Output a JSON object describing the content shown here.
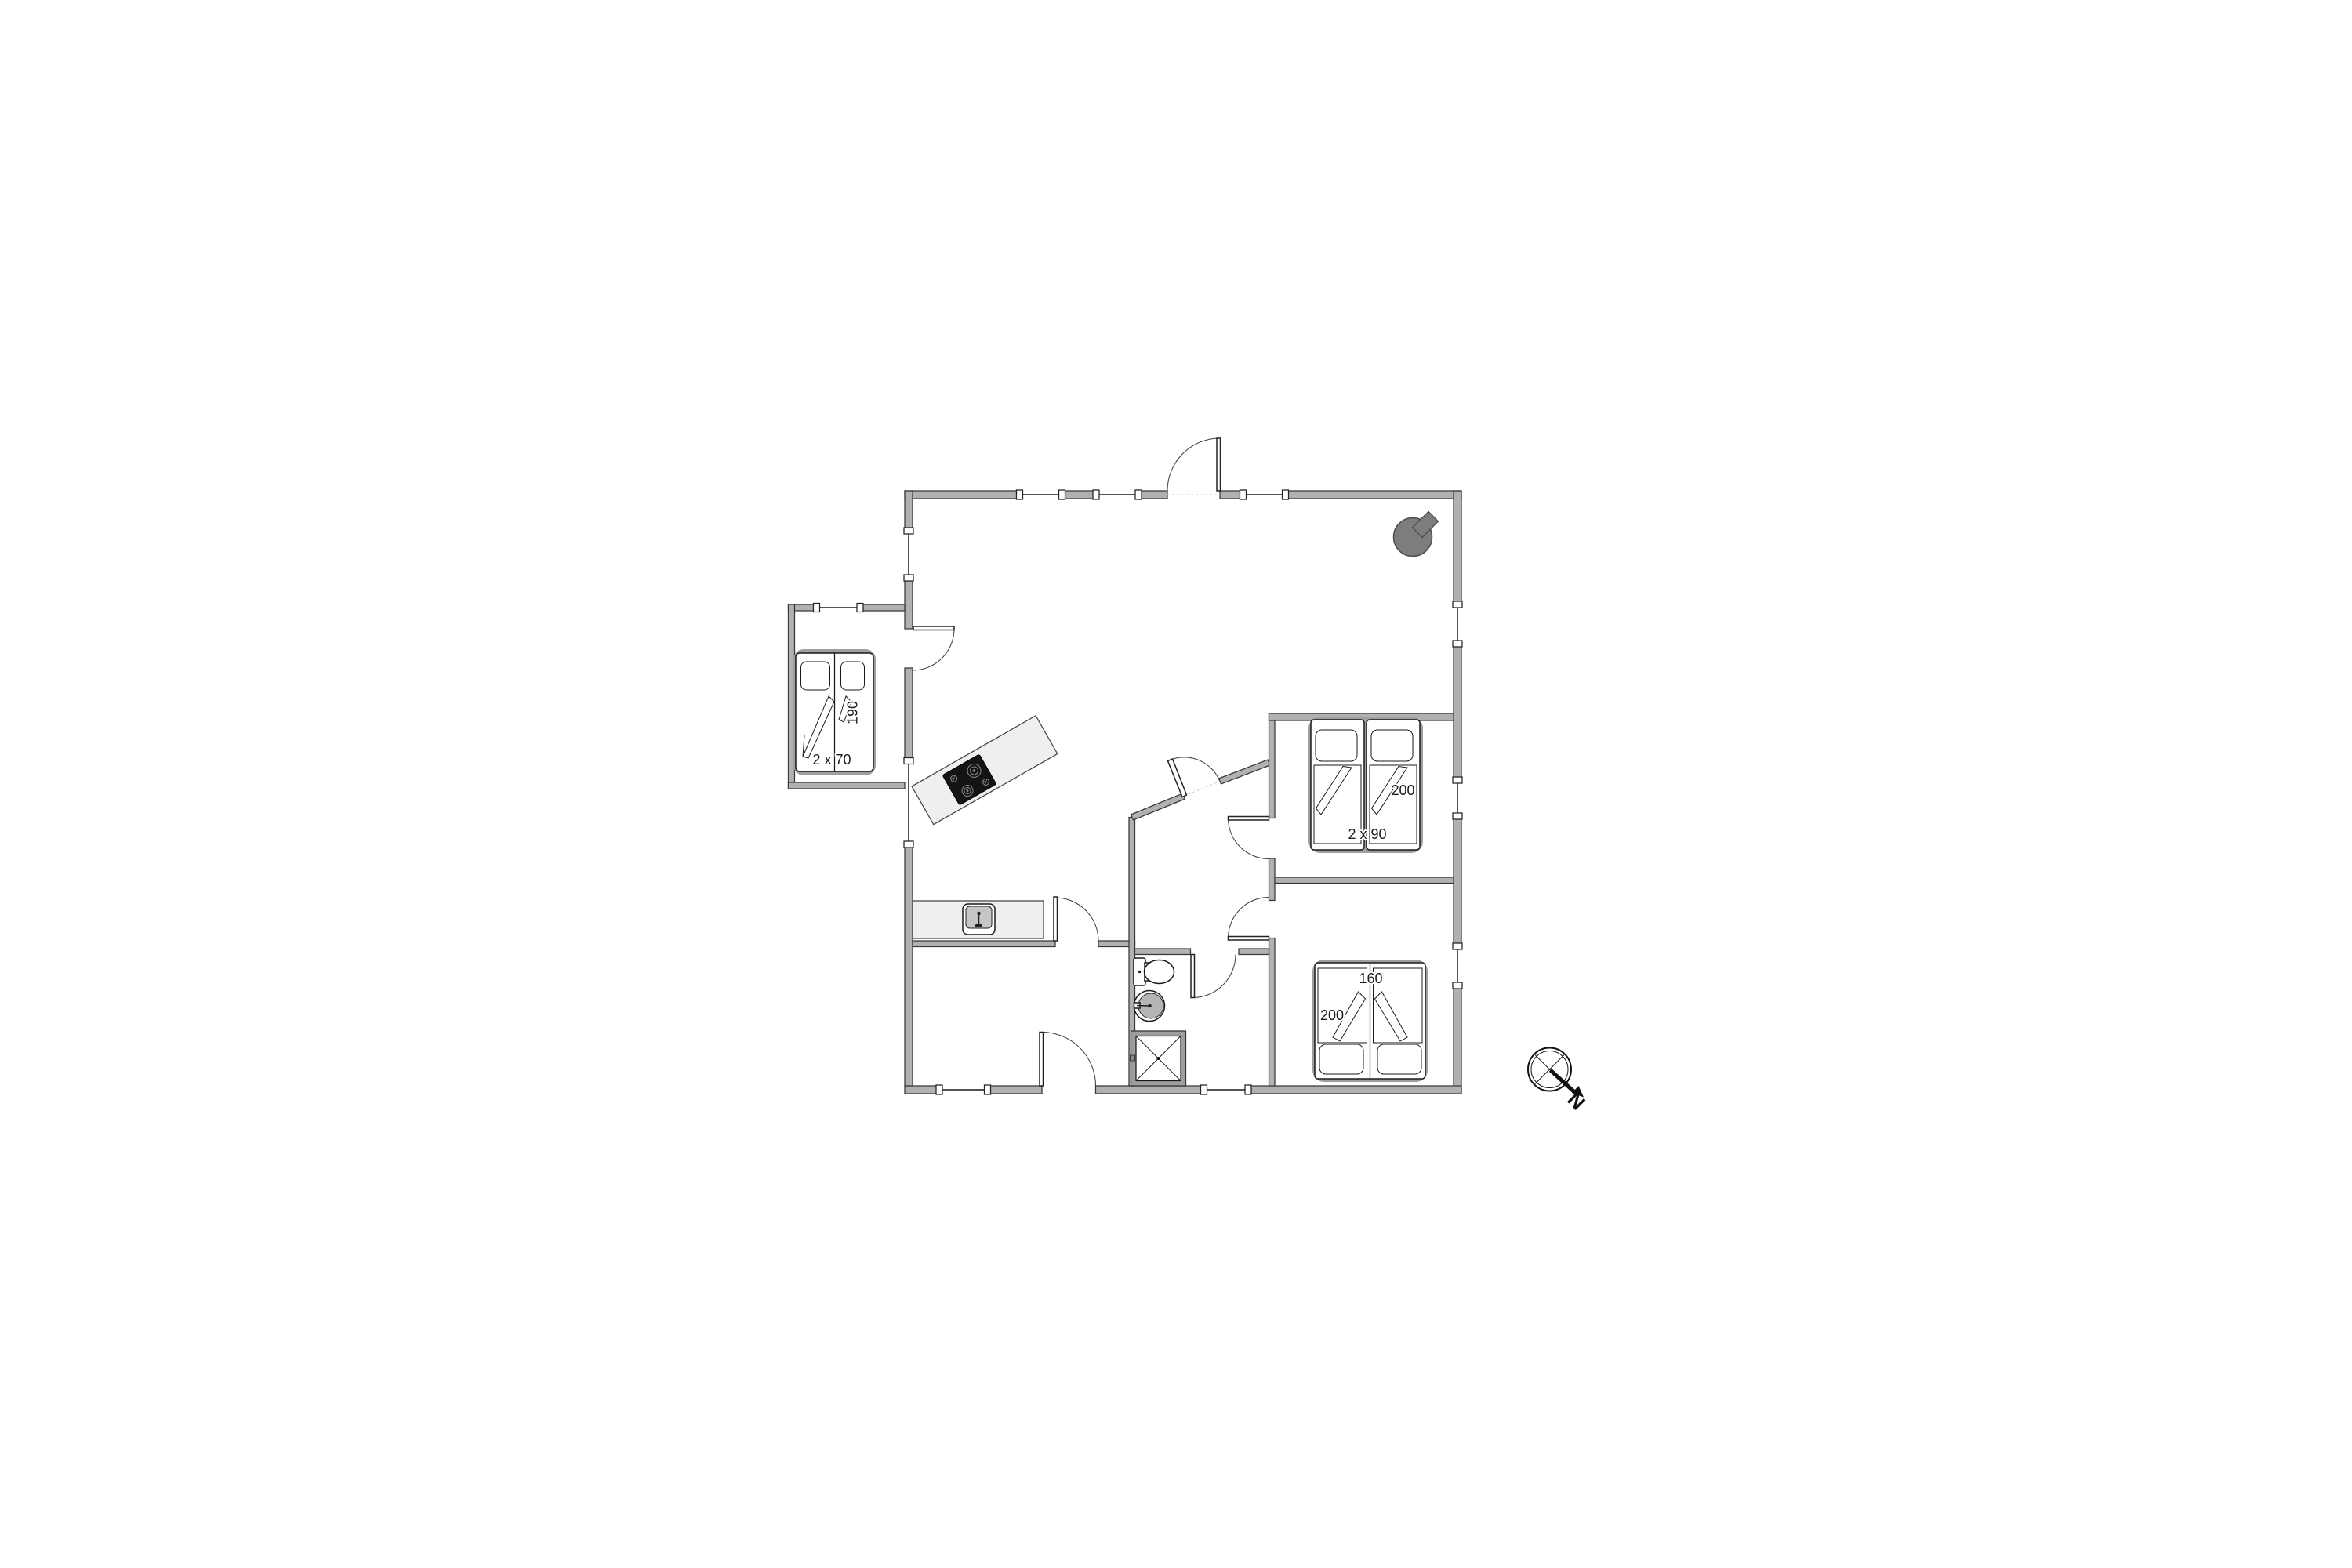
{
  "labels": {
    "annex_bed_width": "2 x 70",
    "annex_bed_length": "190",
    "twin_bed_length": "200",
    "twin_bed_width": "2 x 90",
    "double_bed_width": "160",
    "double_bed_length": "200",
    "compass_north": "N"
  },
  "colors": {
    "wall_fill": "#b1b1b1",
    "wall_stroke": "#383838",
    "window_line": "#1a1a1a",
    "counter_fill": "#efefef",
    "cooktop_fill": "#141414",
    "burner_ring": "#8a8a8a",
    "stove_fill": "#7d7d7d",
    "stove_stroke": "#4c4c4c",
    "sink_inner": "#c6c6c6",
    "shower_frame": "#9e9e9e",
    "bed_backing": "#9f9f9f",
    "label": "#1b1b1b"
  }
}
